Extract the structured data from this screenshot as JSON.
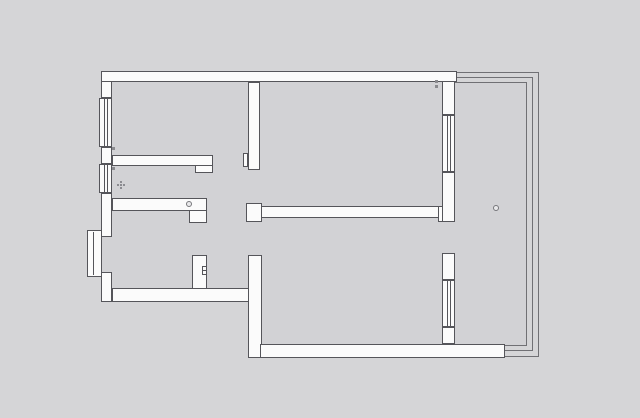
{
  "meta": {
    "title": "apartment-floor-plan",
    "description": "architectural floor plan line drawing, no visible text labels"
  },
  "canvas": {
    "width": 640,
    "height": 418,
    "background": "#d5d5d7",
    "floor_color": "#d2d2d5",
    "wall_fill": "#fbfbfb",
    "wall_stroke": "#55555a",
    "thin_stroke": "#707074",
    "symbol_stroke": "#77777b",
    "mark_color": "#8a8a8e"
  },
  "floors": [
    {
      "name": "floor-kitchen",
      "x": 112,
      "y": 82,
      "w": 136,
      "h": 73
    },
    {
      "name": "floor-hallway",
      "x": 112,
      "y": 166,
      "w": 136,
      "h": 32
    },
    {
      "name": "floor-kitchen-doorway",
      "x": 213,
      "y": 155,
      "w": 35,
      "h": 11
    },
    {
      "name": "floor-living-room",
      "x": 260,
      "y": 82,
      "w": 182,
      "h": 124
    },
    {
      "name": "floor-living-doorway",
      "x": 248,
      "y": 170,
      "w": 12,
      "h": 36
    },
    {
      "name": "floor-foyer",
      "x": 112,
      "y": 211,
      "w": 80,
      "h": 77
    },
    {
      "name": "floor-foyer-opening",
      "x": 192,
      "y": 223,
      "w": 15,
      "h": 32
    },
    {
      "name": "floor-vestibule",
      "x": 207,
      "y": 198,
      "w": 41,
      "h": 90
    },
    {
      "name": "floor-entry-opening",
      "x": 102,
      "y": 237,
      "w": 10,
      "h": 35
    },
    {
      "name": "floor-bedroom",
      "x": 262,
      "y": 218,
      "w": 180,
      "h": 126
    },
    {
      "name": "floor-bedroom-doorway",
      "x": 248,
      "y": 222,
      "w": 14,
      "h": 33
    },
    {
      "name": "floor-balcony-doorway",
      "x": 442,
      "y": 222,
      "w": 13,
      "h": 31
    },
    {
      "name": "floor-balcony",
      "x": 455,
      "y": 82,
      "w": 72,
      "h": 264
    }
  ],
  "walls": [
    {
      "name": "top-exterior-wall",
      "x": 101,
      "y": 71,
      "w": 356,
      "h": 11
    },
    {
      "name": "left-exterior-wall-upper",
      "x": 101,
      "y": 81,
      "w": 11,
      "h": 17
    },
    {
      "name": "left-exterior-wall-mid1",
      "x": 101,
      "y": 147,
      "w": 11,
      "h": 17
    },
    {
      "name": "left-exterior-wall-mid2",
      "x": 101,
      "y": 193,
      "w": 11,
      "h": 44
    },
    {
      "name": "left-exterior-wall-lower",
      "x": 101,
      "y": 272,
      "w": 11,
      "h": 30
    },
    {
      "name": "foyer-south-wall",
      "x": 112,
      "y": 288,
      "w": 137,
      "h": 14
    },
    {
      "name": "kitchen-south-wall",
      "x": 112,
      "y": 155,
      "w": 101,
      "h": 11
    },
    {
      "name": "kitchen-door-jamb",
      "x": 195,
      "y": 165,
      "w": 18,
      "h": 8
    },
    {
      "name": "foyer-north-wall",
      "x": 112,
      "y": 198,
      "w": 95,
      "h": 13
    },
    {
      "name": "foyer-north-jamb",
      "x": 189,
      "y": 210,
      "w": 18,
      "h": 13
    },
    {
      "name": "foyer-east-wall",
      "x": 192,
      "y": 255,
      "w": 15,
      "h": 34
    },
    {
      "name": "central-vertical-wall",
      "x": 248,
      "y": 82,
      "w": 12,
      "h": 88
    },
    {
      "name": "central-vertical-jamb",
      "x": 243,
      "y": 153,
      "w": 5,
      "h": 14
    },
    {
      "name": "central-horizontal-wall",
      "x": 248,
      "y": 206,
      "w": 202,
      "h": 12
    },
    {
      "name": "central-horizontal-left-block",
      "x": 246,
      "y": 203,
      "w": 16,
      "h": 19
    },
    {
      "name": "central-horizontal-right-block",
      "x": 438,
      "y": 206,
      "w": 12,
      "h": 16
    },
    {
      "name": "bedroom-west-wall",
      "x": 248,
      "y": 255,
      "w": 14,
      "h": 103
    },
    {
      "name": "bottom-exterior-wall",
      "x": 260,
      "y": 344,
      "w": 245,
      "h": 14
    },
    {
      "name": "right-wall-upper",
      "x": 442,
      "y": 81,
      "w": 13,
      "h": 34
    },
    {
      "name": "right-wall-mid",
      "x": 442,
      "y": 172,
      "w": 13,
      "h": 50
    },
    {
      "name": "right-wall-lower1",
      "x": 442,
      "y": 253,
      "w": 13,
      "h": 27
    },
    {
      "name": "right-wall-lower2",
      "x": 442,
      "y": 327,
      "w": 13,
      "h": 17
    }
  ],
  "windows": [
    {
      "name": "window-kitchen-left",
      "x": 99,
      "y": 98,
      "w": 13,
      "h": 49
    },
    {
      "name": "window-hallway-left",
      "x": 99,
      "y": 164,
      "w": 13,
      "h": 29
    },
    {
      "name": "window-living-right",
      "x": 442,
      "y": 115,
      "w": 13,
      "h": 57
    },
    {
      "name": "window-bedroom-right",
      "x": 442,
      "y": 280,
      "w": 13,
      "h": 47
    }
  ],
  "door_frames": [
    {
      "name": "entry-door-frame",
      "x": 87,
      "y": 230,
      "w": 15,
      "h": 47,
      "leaf_offset": 5
    }
  ],
  "balcony_frames": [
    {
      "name": "balcony-glazing-outer",
      "x": 455,
      "y": 72,
      "w": 84,
      "h": 285
    },
    {
      "name": "balcony-glazing-middle",
      "x": 455,
      "y": 77,
      "w": 78,
      "h": 274
    },
    {
      "name": "balcony-glazing-inner",
      "x": 455,
      "y": 82,
      "w": 72,
      "h": 264
    }
  ],
  "symbols": [
    {
      "type": "flower",
      "name": "hallway-fixture-symbol",
      "x": 117,
      "y": 181
    },
    {
      "type": "circle",
      "name": "doorway-knob-symbol",
      "x": 186,
      "y": 201,
      "d": 6
    },
    {
      "type": "circle",
      "name": "balcony-drain-symbol",
      "x": 493,
      "y": 205,
      "d": 6
    },
    {
      "type": "outlet",
      "name": "foyer-wall-fixture-symbol",
      "x": 202,
      "y": 266
    },
    {
      "type": "mark",
      "name": "window-tag-mark",
      "x": 112,
      "y": 147,
      "s": 3
    },
    {
      "type": "mark",
      "name": "window-tag-mark",
      "x": 112,
      "y": 167,
      "s": 3
    },
    {
      "type": "mark",
      "name": "room-tag-mark",
      "x": 435,
      "y": 80,
      "s": 3
    },
    {
      "type": "mark",
      "name": "room-tag-mark",
      "x": 435,
      "y": 85,
      "s": 3
    }
  ]
}
